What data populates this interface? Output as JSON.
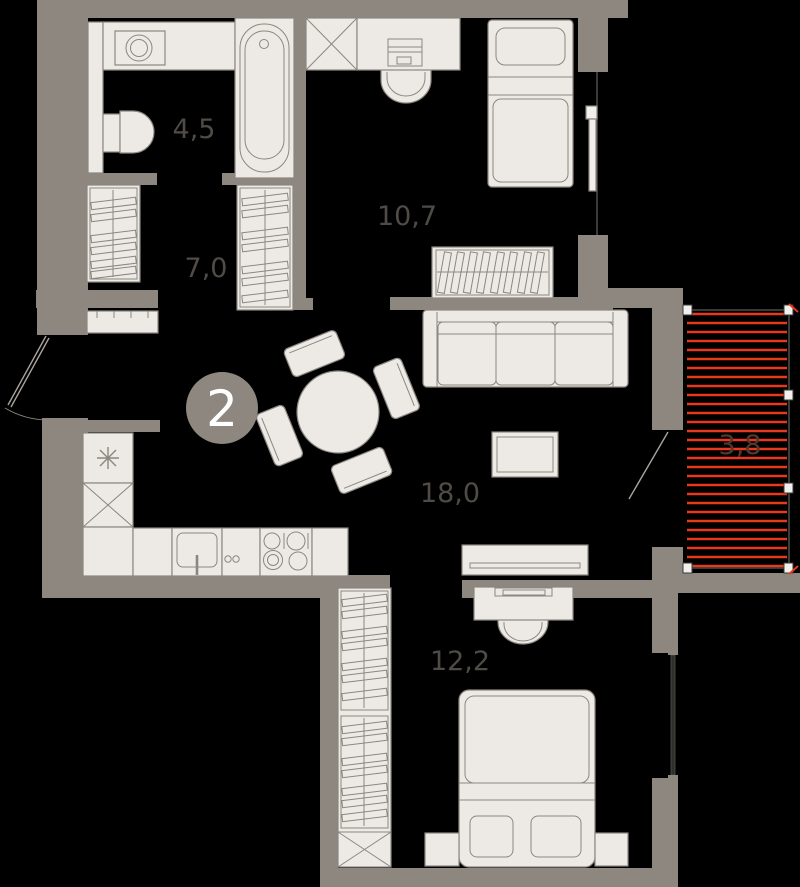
{
  "floor_plan": {
    "unit_number": "2",
    "rooms": [
      {
        "name": "bathroom",
        "area_label": "4,5"
      },
      {
        "name": "hallway",
        "area_label": "7,0"
      },
      {
        "name": "bedroom-small",
        "area_label": "10,7"
      },
      {
        "name": "living-room-kitchen",
        "area_label": "18,0"
      },
      {
        "name": "bedroom-master",
        "area_label": "12,2"
      },
      {
        "name": "balcony",
        "area_label": "3,8"
      }
    ],
    "colors": {
      "wall": "#8d8780",
      "furniture_fill": "#edeae5",
      "furniture_outline": "#8b8680",
      "balcony_heating_stripe": "#e8391d",
      "room_label_text": "#4f4b47",
      "unit_badge_fill": "#8d8780",
      "unit_badge_text": "#ffffff",
      "background": "#000000"
    }
  }
}
